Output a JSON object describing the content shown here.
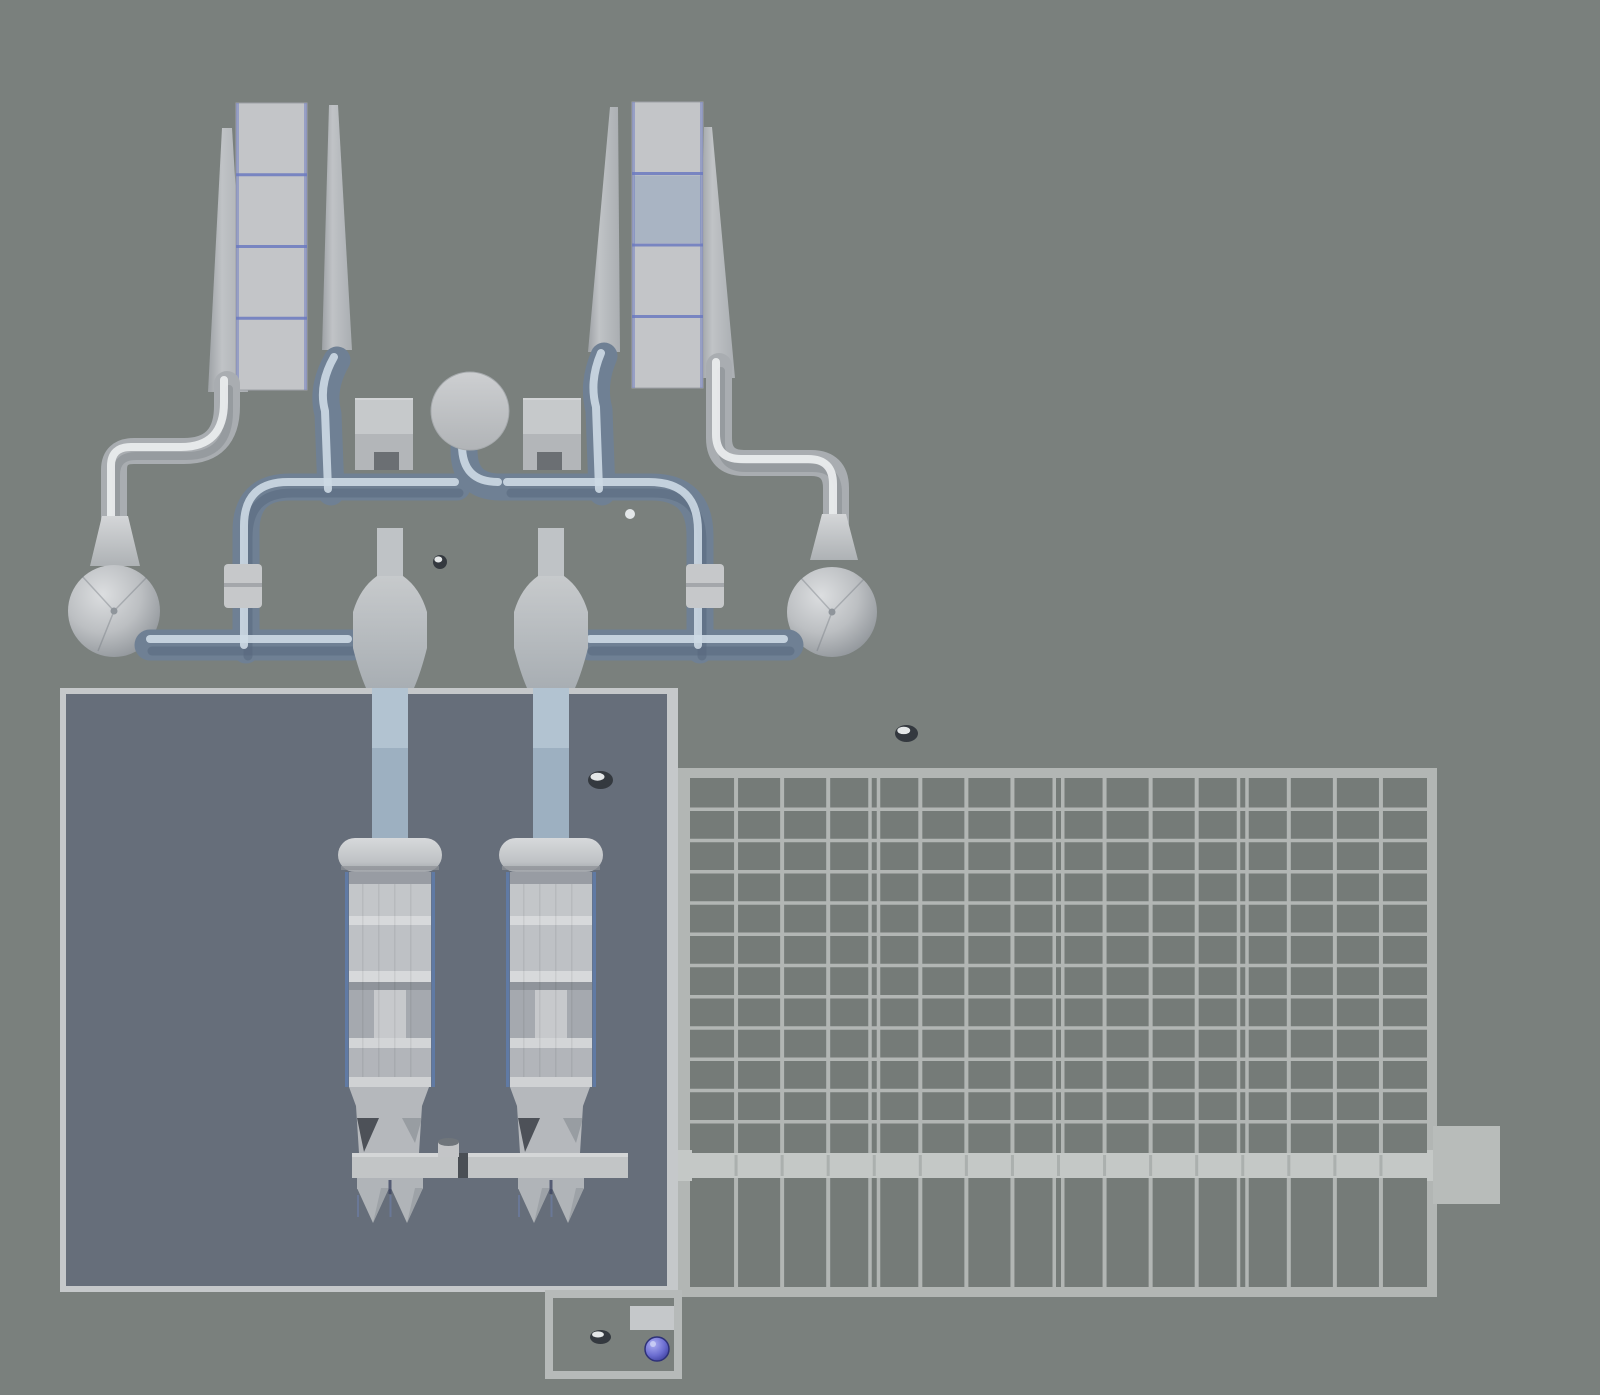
{
  "viewport": {
    "kind": "3d-plant-model-render",
    "width": 1600,
    "height": 1395
  },
  "palette": {
    "bg": "#7a807d",
    "basin_border": "#c5c8ca",
    "basin_fill": "#666e7a",
    "grid_border": "#b2b6b4",
    "grid_fill": "#757b78",
    "grid_line": "#b2b6b4",
    "beam": "#c4c8c6",
    "beam_seam": "#979c9a",
    "tab": "#b8bcba",
    "panel": "#c3c5c8",
    "panel_blue": "#a9b4c3",
    "panel_line": "#6b79c0",
    "pillar": "#bbbec1",
    "pillar_shade": "#9a9ea3",
    "pipe_blue": "#6f8094",
    "pipe_blue_hi": "#cdd9e4",
    "pipe_blue_shade": "#55657b",
    "pipe_metal": "#a9adb1",
    "pipe_metal_hi": "#eceeef",
    "pipe_metal_shade": "#84898e",
    "duct": "#9db0c1",
    "duct_light": "#b2c3d1",
    "funnel": "#bfc3c6",
    "vessel_edge": "#5f7cab",
    "hopper": "#b5b8bc",
    "hopper_shadow": "#2f343c",
    "crossbar": "#c2c5c6",
    "crossbar_seam": "#4a4f55",
    "cone": "#b0b4b8",
    "cone_gap": "#3e4663",
    "bin_top": "#c6c9cb",
    "bin_body": "#b3b6b9",
    "bin_dark": "#6b6f73",
    "clamp": "#c6c8ca",
    "box_border": "#b6bab9",
    "box_panel": "#c5c8ca",
    "orb_ring": "#2e3178",
    "speck_dark": "#34393f",
    "speck_light": "#eef0f1"
  },
  "towers": {
    "segments_per_panel": 4,
    "panels": [
      {
        "x": 236,
        "y": 103,
        "w": 71,
        "h": 287,
        "blue_segment": -1
      },
      {
        "x": 632,
        "y": 102,
        "w": 71,
        "h": 286,
        "blue_segment": 1
      }
    ]
  },
  "grid": {
    "columns": 16,
    "upper_rows": 12,
    "double_line_after_columns": [
      4,
      8,
      12
    ],
    "x0": 690,
    "x1": 1427,
    "y_top": 778,
    "y_beam": 1153,
    "beam_h": 25,
    "y_bottom": 1287
  },
  "vessels": {
    "offsets": [
      0,
      161
    ],
    "band_x": 349,
    "band_w": 82,
    "bands": [
      {
        "y": 872,
        "h": 12,
        "c": "#989ca3"
      },
      {
        "y": 884,
        "h": 32,
        "c": "#c3c6c9"
      },
      {
        "y": 916,
        "h": 9,
        "c": "#d7d9db"
      },
      {
        "y": 925,
        "h": 46,
        "c": "#bec1c5"
      },
      {
        "y": 971,
        "h": 11,
        "c": "#d7d9db"
      },
      {
        "y": 982,
        "h": 8,
        "c": "#8f949b"
      },
      {
        "y": 990,
        "h": 48,
        "c": "#a5a9af"
      },
      {
        "y": 990,
        "h": 48,
        "c": "#c7c9cc",
        "x": 374,
        "w": 32
      },
      {
        "y": 1038,
        "h": 10,
        "c": "#d3d5d7"
      },
      {
        "y": 1048,
        "h": 29,
        "c": "#b2b5ba"
      },
      {
        "y": 1077,
        "h": 10,
        "c": "#d0d2d4"
      }
    ],
    "crossbars": [
      {
        "x": 352,
        "w": 106
      },
      {
        "x": 468,
        "w": 160
      }
    ]
  },
  "specks": [
    {
      "x": 433,
      "y": 555,
      "w": 14,
      "h": 14
    },
    {
      "x": 895,
      "y": 725,
      "w": 23,
      "h": 17
    },
    {
      "x": 588,
      "y": 771,
      "w": 25,
      "h": 18
    },
    {
      "x": 590,
      "y": 1330,
      "w": 21,
      "h": 14
    }
  ],
  "equipment": {
    "tower_left": "inclined-conveyor-tower-left",
    "tower_right": "inclined-conveyor-tower-right",
    "sphere_left": "sphere-tank-left",
    "sphere_right": "sphere-tank-right",
    "center_tank": "circular-holding-tank",
    "bins": [
      "feed-bin-left",
      "feed-bin-right"
    ],
    "vessels": [
      "process-vessel-1",
      "process-vessel-2"
    ],
    "basin": "settling-basin",
    "grid": "filter-grid-basin",
    "channel": "collection-channel",
    "outlet": "outlet-chamber"
  }
}
